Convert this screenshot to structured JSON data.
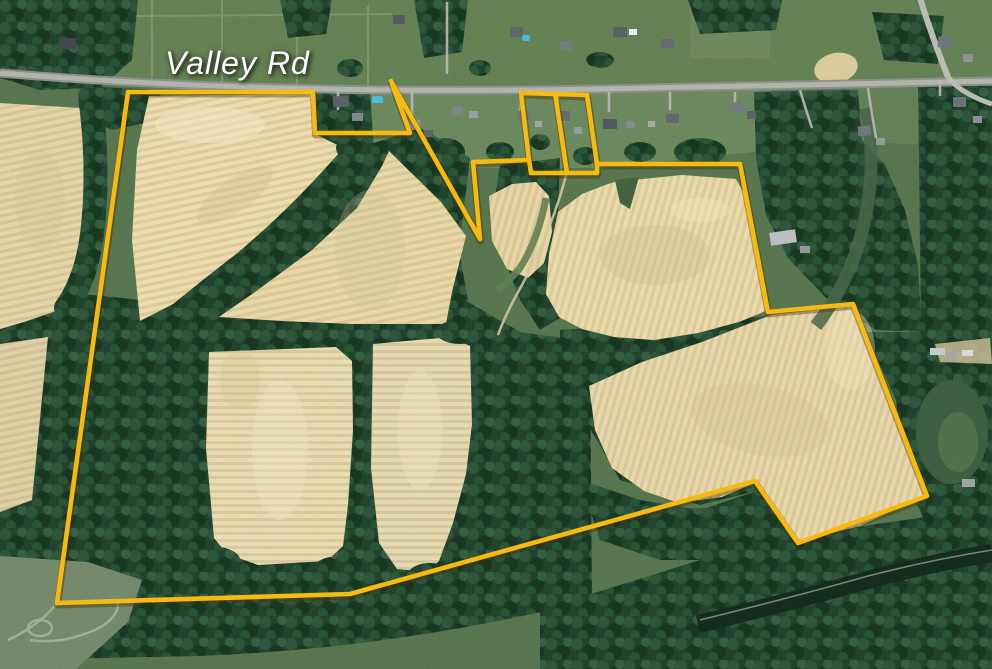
{
  "map": {
    "road_label": "Valley Rd",
    "colors": {
      "boundary": "#f6ba10",
      "boundary_shadow": "rgba(70,45,0,0.40)",
      "label": "#ffffff",
      "road": "#aaaea6",
      "field": "#e8d7a6",
      "forest": "#20402c",
      "lawn": "#62794f"
    },
    "boundary": {
      "main": [
        [
          128,
          92
        ],
        [
          313,
          92
        ],
        [
          315,
          133
        ],
        [
          410,
          133
        ],
        [
          391,
          81
        ],
        [
          480,
          239
        ],
        [
          473,
          162
        ],
        [
          529,
          160
        ],
        [
          531,
          173
        ],
        [
          597,
          173
        ],
        [
          597,
          164
        ],
        [
          740,
          164
        ],
        [
          768,
          312
        ],
        [
          853,
          304
        ],
        [
          927,
          496
        ],
        [
          798,
          543
        ],
        [
          755,
          481
        ],
        [
          350,
          594
        ],
        [
          57,
          603
        ]
      ],
      "strips": [
        [
          [
            529,
            160
          ],
          [
            521,
            93
          ],
          [
            587,
            95
          ],
          [
            597,
            164
          ]
        ],
        [
          [
            555,
            93
          ],
          [
            567,
            173
          ]
        ]
      ]
    }
  }
}
